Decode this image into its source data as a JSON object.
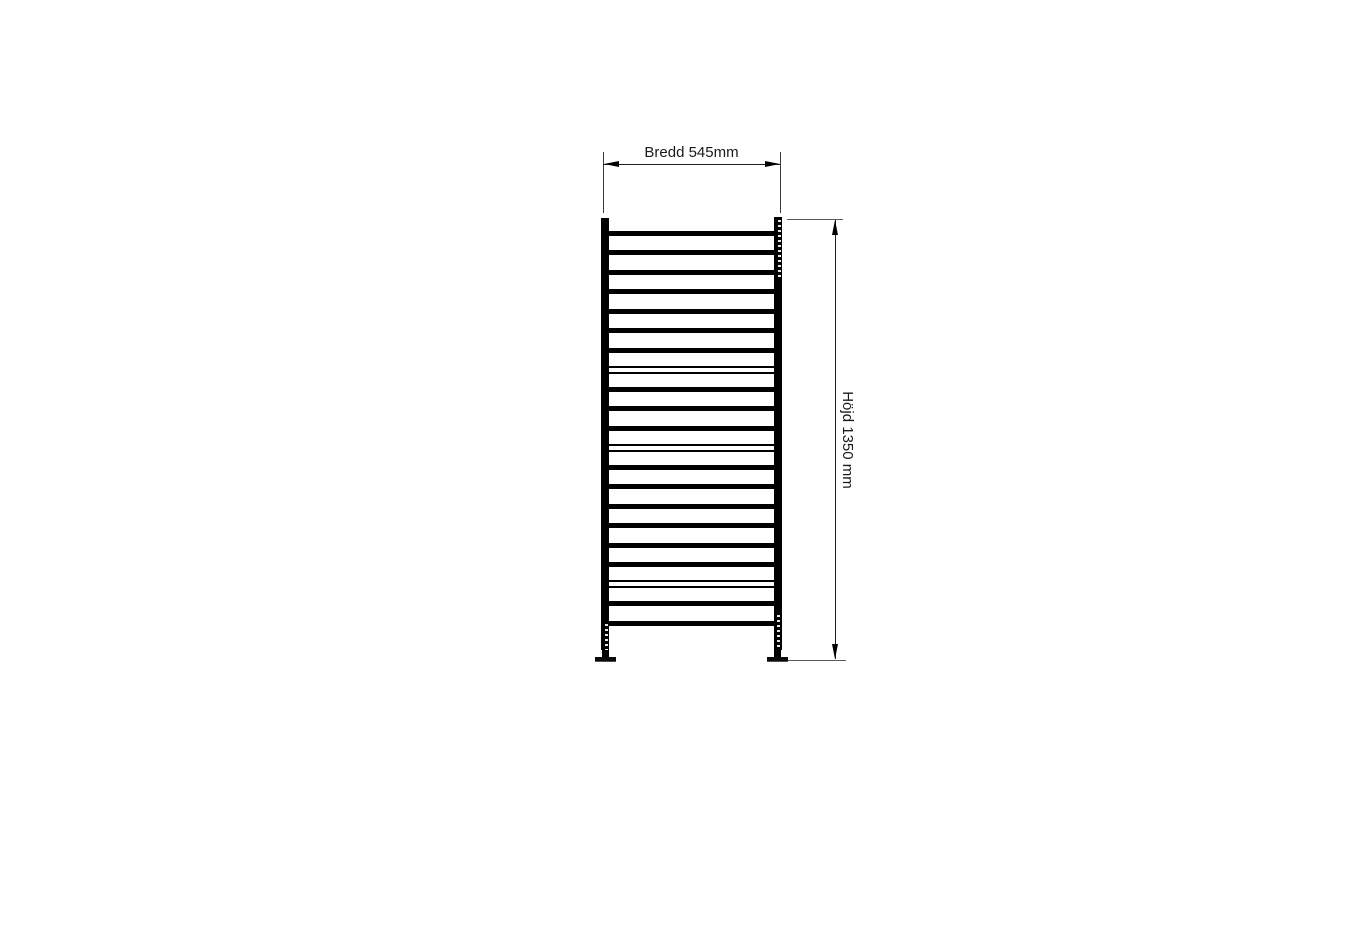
{
  "canvas": {
    "width_px": 1353,
    "height_px": 936,
    "background": "#ffffff"
  },
  "drawing": {
    "subject": "ladder-towel-radiator-front-elevation",
    "colors": {
      "structure": "#000000",
      "dimension_lines": "#3c3c3c",
      "text": "#1a1a1a"
    },
    "width_dimension": {
      "label": "Bredd 545mm",
      "value_mm": 545
    },
    "height_dimension": {
      "label": "Höjd 1350 mm",
      "value_mm": 1350
    },
    "structure": {
      "rung_count": 21,
      "rungs": [
        {
          "y": 230.5,
          "style": "solid"
        },
        {
          "y": 250,
          "style": "solid"
        },
        {
          "y": 269.5,
          "style": "solid"
        },
        {
          "y": 289,
          "style": "solid"
        },
        {
          "y": 308.5,
          "style": "solid"
        },
        {
          "y": 328,
          "style": "solid"
        },
        {
          "y": 347.5,
          "style": "solid"
        },
        {
          "y": 365.5,
          "style": "outline"
        },
        {
          "y": 386.5,
          "style": "solid"
        },
        {
          "y": 406,
          "style": "solid"
        },
        {
          "y": 425.5,
          "style": "solid"
        },
        {
          "y": 443.5,
          "style": "outline"
        },
        {
          "y": 464.5,
          "style": "solid"
        },
        {
          "y": 484,
          "style": "solid"
        },
        {
          "y": 503.5,
          "style": "solid"
        },
        {
          "y": 523,
          "style": "solid"
        },
        {
          "y": 542.5,
          "style": "solid"
        },
        {
          "y": 562,
          "style": "solid"
        },
        {
          "y": 580,
          "style": "outline"
        },
        {
          "y": 601,
          "style": "solid"
        },
        {
          "y": 620.5,
          "style": "solid"
        }
      ]
    }
  }
}
